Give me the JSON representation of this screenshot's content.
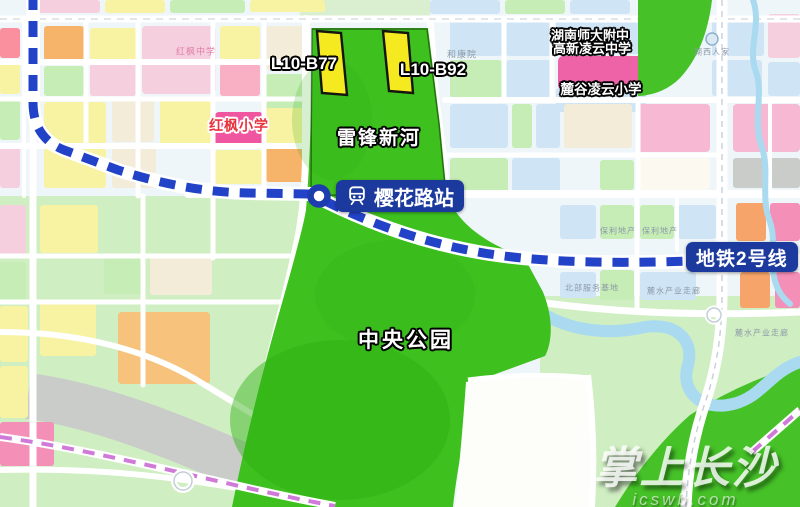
{
  "map": {
    "labels": {
      "plot_b77": "L10-B77",
      "plot_b92": "L10-B92",
      "river_name": "雷锋新河",
      "station_name": "樱花路站",
      "metro_line_name": "地铁2号线",
      "park_name": "中央公园",
      "hongfeng_primary": "红枫小学",
      "affiliated_middle_line1": "湖南师大附中",
      "affiliated_middle_line2": "高新凌云中学",
      "lugu_lingyun_primary": "麓谷凌云小学",
      "hongfeng_middle": "红枫中学",
      "hekangyuan": "和康院",
      "huxi_renjia": "湖西人家",
      "baoli_estate_1": "保利地产",
      "baoli_estate_2": "保利地产",
      "north_service_base": "北部服务基地",
      "industry_corridor_1": "麓水产业走廊",
      "industry_corridor_2": "麓水产业走廊"
    },
    "watermark": {
      "title": "掌上长沙",
      "site": "icswb.com"
    },
    "colors": {
      "park_green": "#3ec01f",
      "metro_blue": "#2243c8",
      "label_navy": "#1c3a9e",
      "plot_yellow": "#f5e920",
      "school_pink": "#ee63a8",
      "station_ring_blue": "#1d3cae",
      "river_blue": "#a9daf0",
      "corridor_purple": "#cf79d8"
    }
  }
}
